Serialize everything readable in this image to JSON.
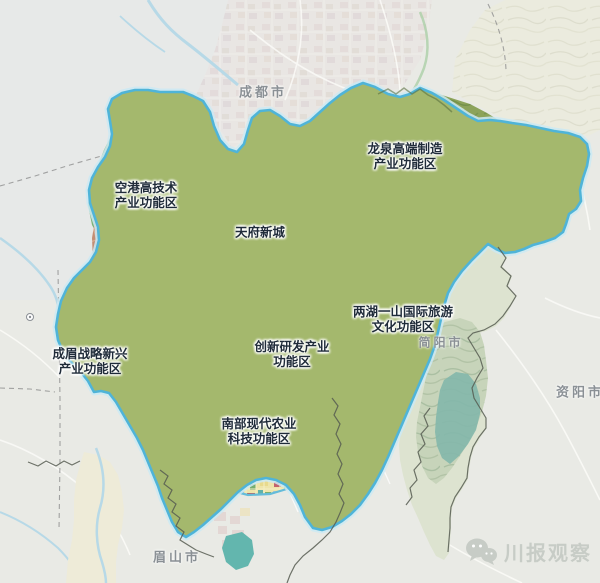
{
  "map": {
    "region": "成都天府新区功能分区示意图",
    "city_labels": [
      {
        "id": "chengdu",
        "text": "成都市"
      },
      {
        "id": "jianyang",
        "text": "简阳市"
      },
      {
        "id": "ziyang",
        "text": "资阳市"
      },
      {
        "id": "meishan",
        "text": "眉山市"
      }
    ],
    "zone_labels": [
      {
        "id": "konggang",
        "line1": "空港高技术",
        "line2": "产业功能区"
      },
      {
        "id": "longquan",
        "line1": "龙泉高端制造",
        "line2": "产业功能区"
      },
      {
        "id": "tianfu",
        "line1": "天府新城",
        "line2": ""
      },
      {
        "id": "lianghu",
        "line1": "两湖一山国际旅游",
        "line2": "文化功能区"
      },
      {
        "id": "chuangxin",
        "line1": "创新研发产业",
        "line2": "功能区"
      },
      {
        "id": "chengmei",
        "line1": "成眉战略新兴",
        "line2": "产业功能区"
      },
      {
        "id": "nanbu",
        "line1": "南部现代农业",
        "line2": "科技功能区"
      }
    ],
    "watermark": {
      "text": "川报观察",
      "icon": "wechat-icon"
    }
  },
  "colors": {
    "zone_label": "#1f2b39",
    "city_label": "#8a9095",
    "watermark": "#c6cbc5",
    "boundary_cyan": "#4fb4d8",
    "agri_green": "#a4b86d",
    "mountain_olive": "#8ca35a",
    "urban_yellow": "#efe5a2",
    "urban_red": "#b44a55",
    "water_blue": "#9ed2e2",
    "outside_pale": "#e9eae5"
  }
}
